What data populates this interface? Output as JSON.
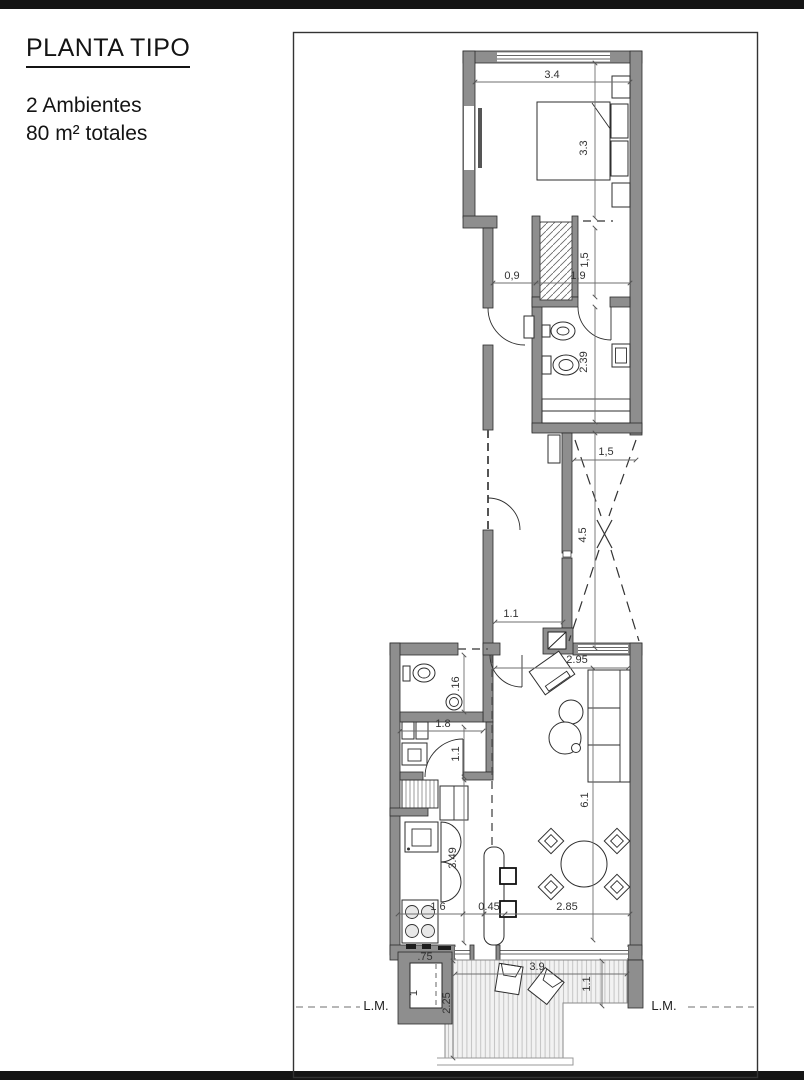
{
  "page": {
    "background": "#ffffff",
    "top_bar_color": "#151515",
    "bottom_bar_color": "#151515"
  },
  "title_block": {
    "title": "PLANTA TIPO",
    "line1": "2 Ambientes",
    "line2": "80 m² totales"
  },
  "plan": {
    "colors": {
      "wall": "#8e8e8e",
      "line": "#2b2b2b",
      "deck_hatch": "#c4c4c4",
      "dim_line": "#6f6f6f"
    },
    "dims": {
      "bedroom_width": "3.4",
      "bedroom_depth": "3.3",
      "hall_width": "0,9",
      "wardrobe_width": "1,9",
      "wardrobe_depth": "1,5",
      "bathroom_depth": "2.39",
      "shaft_width": "1,5",
      "shaft_depth": "4.5",
      "corridor_width": "1.1",
      "living_width": "2.95",
      "toilette_depth": ".16",
      "laundry_width": "1.8",
      "laundry_depth": "1.1",
      "living_depth": "6.1",
      "kitchen_depth": "3.49",
      "counter_width": "1.6",
      "island_width": "0.45",
      "dining_width": "2.85",
      "balcony_width": "3.9",
      "balcony_depth": "1.1",
      "terrace_depth": "2.25",
      "planter_width": ".75",
      "planter_depth": "1"
    },
    "boundary": {
      "lm_left": "L.M.",
      "lm_right": "L.M."
    }
  }
}
